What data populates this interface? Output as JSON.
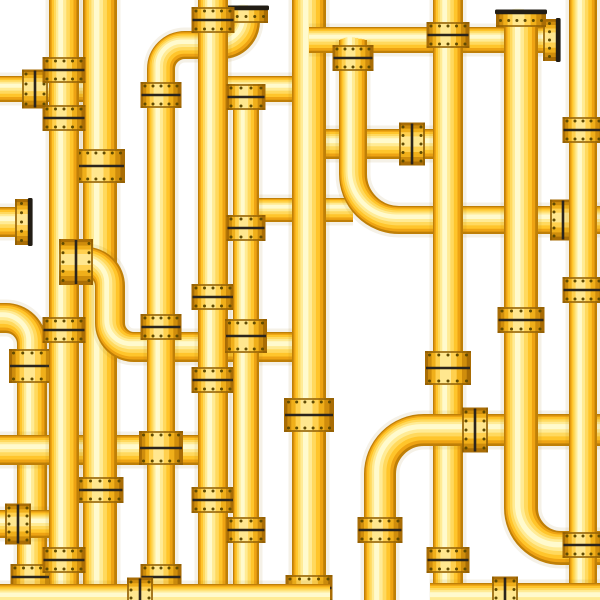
{
  "illustration": {
    "label": "Golden yellow industrial pipeline network pattern on white background",
    "canvas": {
      "width": 600,
      "height": 600,
      "background": "#ffffff"
    },
    "palette": {
      "background": "#ffffff",
      "pipe_glow": "rgba(160,120,20,0.10)",
      "pipe_layers": [
        "#bf7f07",
        "#eea313",
        "#ffc52b",
        "#ffd95e",
        "#ffeb95",
        "#fffacd"
      ],
      "coupling_layers": [
        "#a96d05",
        "#cf8d0c",
        "#f0af1a",
        "#ffd04e",
        "#ffe78f"
      ],
      "gasket": "#2a241c",
      "rim": "#8f5e04",
      "bolt": "#5f4a03",
      "cap": "#221d15"
    },
    "pipes": [
      {
        "name": "stub-left-end",
        "width": 30,
        "radius": 1,
        "points": [
          [
            -6,
            222
          ],
          [
            30,
            222
          ]
        ],
        "couplings": [],
        "ends": [
          {
            "x": 30,
            "y": 222,
            "dir": "right"
          }
        ]
      },
      {
        "name": "left-drop",
        "width": 30,
        "radius": 26,
        "points": [
          [
            -8,
            318
          ],
          [
            32,
            318
          ],
          [
            32,
            606
          ]
        ],
        "couplings": [
          {
            "x": 32,
            "y": 366,
            "axis": "v",
            "size": "l"
          },
          {
            "x": 32,
            "y": 577,
            "axis": "v",
            "size": "m"
          }
        ],
        "ends": []
      },
      {
        "name": "h-lower-left",
        "width": 28,
        "radius": 1,
        "points": [
          [
            -6,
            524
          ],
          [
            66,
            524
          ]
        ],
        "couplings": [
          {
            "x": 18,
            "y": 524,
            "axis": "h",
            "size": "m"
          }
        ],
        "ends": []
      },
      {
        "name": "h-mid-left",
        "width": 30,
        "radius": 1,
        "points": [
          [
            -6,
            450
          ],
          [
            215,
            450
          ]
        ],
        "couplings": [],
        "ends": []
      },
      {
        "name": "h-top-left",
        "width": 26,
        "radius": 1,
        "points": [
          [
            -6,
            89
          ],
          [
            102,
            89
          ]
        ],
        "couplings": [
          {
            "x": 35,
            "y": 89,
            "axis": "h",
            "size": "m"
          }
        ],
        "ends": []
      },
      {
        "name": "v-main-b",
        "width": 34,
        "radius": 1,
        "points": [
          [
            100,
            -6
          ],
          [
            100,
            606
          ]
        ],
        "couplings": [
          {
            "x": 100,
            "y": 166,
            "axis": "v",
            "size": "l"
          },
          {
            "x": 100,
            "y": 490,
            "axis": "v",
            "size": "m"
          }
        ],
        "ends": []
      },
      {
        "name": "v-main-a",
        "width": 30,
        "radius": 1,
        "points": [
          [
            64,
            -6
          ],
          [
            64,
            606
          ]
        ],
        "couplings": [
          {
            "x": 64,
            "y": 70,
            "axis": "v",
            "size": "m"
          },
          {
            "x": 64,
            "y": 118,
            "axis": "v",
            "size": "m"
          },
          {
            "x": 64,
            "y": 330,
            "axis": "v",
            "size": "m"
          },
          {
            "x": 64,
            "y": 560,
            "axis": "v",
            "size": "m"
          }
        ],
        "ends": []
      },
      {
        "name": "s-curve",
        "width": 30,
        "radius": 24,
        "points": [
          [
            64,
            262
          ],
          [
            110,
            262
          ],
          [
            110,
            347
          ],
          [
            309,
            347
          ]
        ],
        "couplings": [
          {
            "x": 76,
            "y": 262,
            "axis": "h",
            "size": "l"
          }
        ],
        "ends": []
      },
      {
        "name": "h-b",
        "width": 26,
        "radius": 1,
        "points": [
          [
            213,
            89
          ],
          [
            309,
            89
          ]
        ],
        "couplings": [],
        "ends": []
      },
      {
        "name": "h-j",
        "width": 24,
        "radius": 1,
        "points": [
          [
            246,
            210
          ],
          [
            353,
            210
          ]
        ],
        "couplings": [],
        "ends": []
      },
      {
        "name": "z-top",
        "width": 28,
        "radius": 24,
        "points": [
          [
            161,
            606
          ],
          [
            161,
            45
          ],
          [
            246,
            45
          ],
          [
            246,
            8
          ]
        ],
        "couplings": [
          {
            "x": 161,
            "y": 95,
            "axis": "v",
            "size": "m"
          },
          {
            "x": 161,
            "y": 327,
            "axis": "v",
            "size": "m"
          },
          {
            "x": 161,
            "y": 448,
            "axis": "v",
            "size": "l"
          },
          {
            "x": 161,
            "y": 577,
            "axis": "v",
            "size": "m"
          }
        ],
        "ends": [
          {
            "x": 246,
            "y": 8,
            "dir": "up"
          }
        ]
      },
      {
        "name": "v-c",
        "width": 30,
        "radius": 1,
        "points": [
          [
            213,
            -6
          ],
          [
            213,
            606
          ]
        ],
        "couplings": [
          {
            "x": 213,
            "y": 20,
            "axis": "v",
            "size": "m"
          },
          {
            "x": 213,
            "y": 297,
            "axis": "v",
            "size": "m"
          },
          {
            "x": 213,
            "y": 380,
            "axis": "v",
            "size": "m"
          },
          {
            "x": 213,
            "y": 500,
            "axis": "v",
            "size": "m"
          }
        ],
        "ends": []
      },
      {
        "name": "v-d",
        "width": 26,
        "radius": 1,
        "points": [
          [
            246,
            89
          ],
          [
            246,
            606
          ]
        ],
        "couplings": [
          {
            "x": 246,
            "y": 97,
            "axis": "v",
            "size": "m"
          },
          {
            "x": 246,
            "y": 228,
            "axis": "v",
            "size": "m"
          },
          {
            "x": 246,
            "y": 336,
            "axis": "v",
            "size": "l"
          },
          {
            "x": 246,
            "y": 530,
            "axis": "v",
            "size": "m"
          }
        ],
        "ends": []
      },
      {
        "name": "h-mid",
        "width": 30,
        "radius": 1,
        "points": [
          [
            309,
            144
          ],
          [
            450,
            144
          ]
        ],
        "couplings": [
          {
            "x": 412,
            "y": 144,
            "axis": "h",
            "size": "m"
          }
        ],
        "ends": []
      },
      {
        "name": "v-e",
        "width": 34,
        "radius": 1,
        "points": [
          [
            309,
            -6
          ],
          [
            309,
            606
          ]
        ],
        "couplings": [
          {
            "x": 309,
            "y": 415,
            "axis": "v",
            "size": "l"
          },
          {
            "x": 309,
            "y": 588,
            "axis": "v",
            "size": "m"
          }
        ],
        "ends": []
      },
      {
        "name": "h-top2",
        "width": 26,
        "radius": 1,
        "points": [
          [
            309,
            40
          ],
          [
            558,
            40
          ]
        ],
        "couplings": [],
        "ends": [
          {
            "x": 558,
            "y": 40,
            "dir": "right"
          }
        ]
      },
      {
        "name": "v-f-sweep",
        "width": 28,
        "radius": 46,
        "points": [
          [
            353,
            40
          ],
          [
            353,
            220
          ],
          [
            606,
            220
          ]
        ],
        "couplings": [
          {
            "x": 353,
            "y": 58,
            "axis": "v",
            "size": "m"
          },
          {
            "x": 563,
            "y": 220,
            "axis": "h",
            "size": "m"
          }
        ],
        "ends": []
      },
      {
        "name": "v-h",
        "width": 30,
        "radius": 1,
        "points": [
          [
            448,
            -6
          ],
          [
            448,
            606
          ]
        ],
        "couplings": [
          {
            "x": 448,
            "y": 35,
            "axis": "v",
            "size": "m"
          },
          {
            "x": 448,
            "y": 368,
            "axis": "v",
            "size": "l"
          },
          {
            "x": 448,
            "y": 560,
            "axis": "v",
            "size": "m"
          }
        ],
        "ends": []
      },
      {
        "name": "j-curve",
        "width": 32,
        "radius": 44,
        "points": [
          [
            606,
            430
          ],
          [
            380,
            430
          ],
          [
            380,
            606
          ]
        ],
        "couplings": [
          {
            "x": 475,
            "y": 430,
            "axis": "h",
            "size": "m"
          },
          {
            "x": 380,
            "y": 530,
            "axis": "v",
            "size": "m"
          }
        ],
        "ends": []
      },
      {
        "name": "v-i",
        "width": 34,
        "radius": 40,
        "points": [
          [
            521,
            12
          ],
          [
            521,
            548
          ],
          [
            606,
            548
          ]
        ],
        "couplings": [
          {
            "x": 521,
            "y": 320,
            "axis": "v",
            "size": "m"
          }
        ],
        "ends": [
          {
            "x": 521,
            "y": 12,
            "dir": "up"
          }
        ]
      },
      {
        "name": "v-k",
        "width": 28,
        "radius": 1,
        "points": [
          [
            583,
            -6
          ],
          [
            583,
            606
          ]
        ],
        "couplings": [
          {
            "x": 583,
            "y": 130,
            "axis": "v",
            "size": "m"
          },
          {
            "x": 583,
            "y": 290,
            "axis": "v",
            "size": "m"
          },
          {
            "x": 583,
            "y": 545,
            "axis": "v",
            "size": "m"
          }
        ],
        "ends": []
      },
      {
        "name": "h-bottom-left",
        "width": 28,
        "radius": 1,
        "points": [
          [
            -6,
            598
          ],
          [
            330,
            598
          ]
        ],
        "couplings": [
          {
            "x": 140,
            "y": 598,
            "axis": "h",
            "size": "m"
          }
        ],
        "ends": []
      },
      {
        "name": "h-bottom-right",
        "width": 30,
        "radius": 1,
        "points": [
          [
            430,
            598
          ],
          [
            606,
            598
          ]
        ],
        "couplings": [
          {
            "x": 505,
            "y": 598,
            "axis": "h",
            "size": "m"
          }
        ],
        "ends": []
      }
    ]
  }
}
